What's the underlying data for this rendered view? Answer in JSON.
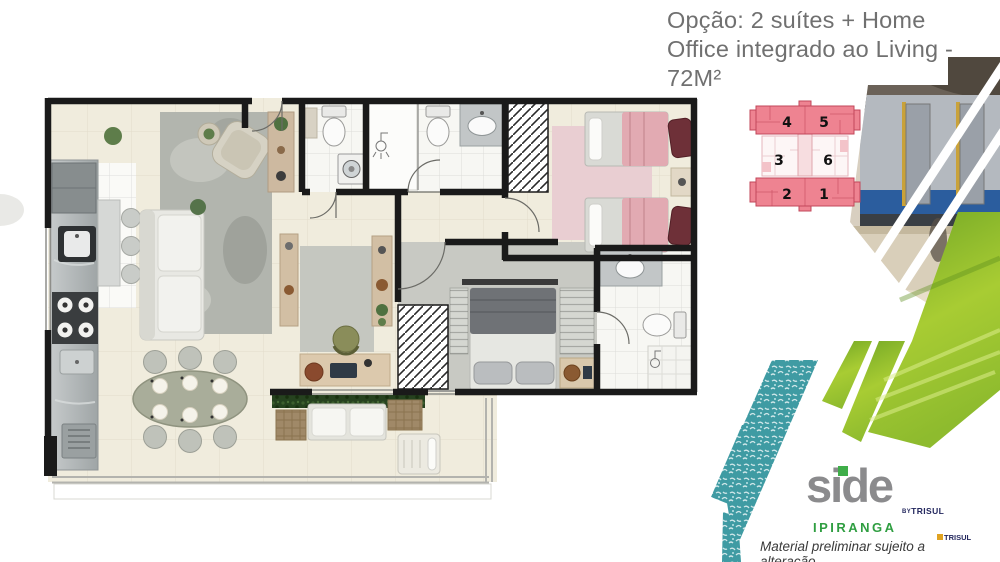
{
  "title": {
    "line1": "Opção: 2 suítes + Home",
    "line2": "Office integrado ao Living -",
    "line3": "72M²"
  },
  "keyplan": {
    "units": [
      "4",
      "5",
      "3",
      "6",
      "2",
      "1"
    ]
  },
  "branding": {
    "logo": "side",
    "by": "BY",
    "developer": "TRISUL",
    "location": "IPIRANGA",
    "disclaimer": "Material preliminar sujeito a alteração"
  },
  "collage": {
    "bands": [
      "pool-water-texture",
      "park-grass-photo",
      "subway-station-photo"
    ]
  },
  "colors": {
    "title_gray": "#707070",
    "wall_black": "#1a1a1a",
    "floor_cream": "#f0ecdd",
    "keyplan_pink": "#ee8391",
    "keyplan_line_red": "#c2475a",
    "teal_water": "#3f9ba3",
    "grass_green": "#8fbe2f",
    "logo_gray": "#8b8b8d",
    "logo_green_square": "#3fae49",
    "ipiranga_green": "#2f9e41",
    "trisul_navy": "#23275e",
    "bed_pink": "#e2aab2"
  }
}
